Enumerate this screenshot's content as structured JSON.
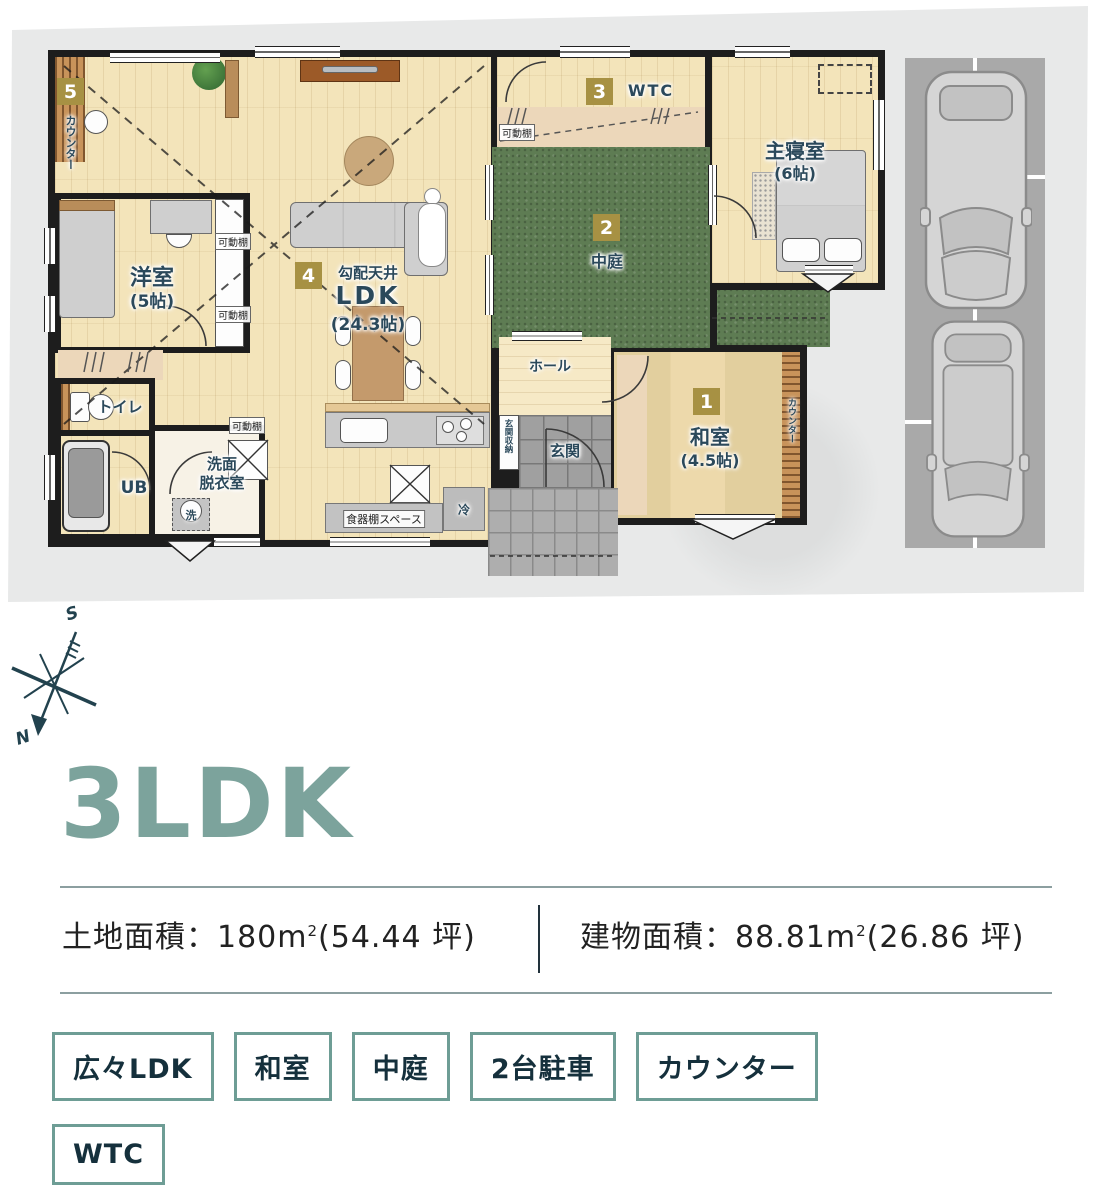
{
  "plan": {
    "badges": {
      "b1": "1",
      "b2": "2",
      "b3": "3",
      "b4": "4",
      "b5": "5"
    },
    "rooms": {
      "main_bedroom": {
        "name": "主寝室",
        "size": "(6帖)"
      },
      "western_room": {
        "name": "洋室",
        "size": "(5帖)"
      },
      "japanese_room": {
        "name": "和室",
        "size": "(4.5帖)"
      },
      "ldk": {
        "ceiling": "勾配天井",
        "name": "LDK",
        "size": "(24.3帖)"
      },
      "courtyard": {
        "name": "中庭"
      },
      "wtc": {
        "name": "WTC"
      },
      "hall": {
        "name": "ホール"
      },
      "entrance": {
        "name": "玄関"
      },
      "toilet": {
        "name": "トイレ"
      },
      "bath": {
        "name": "UB"
      },
      "washroom": {
        "line1": "洗面",
        "line2": "脱衣室"
      }
    },
    "small": {
      "movable_shelf": "可動棚",
      "entrance_storage": "玄関収納",
      "counter": "カウンター",
      "dish_shelf": "食器棚スペース",
      "fridge": "冷",
      "washer": "洗"
    },
    "compass": {
      "south": "S",
      "north": "N"
    }
  },
  "info": {
    "title": "3LDK",
    "land_label": "土地面積：",
    "land_value": "180m",
    "land_sup": "2",
    "land_tsubo": "(54.44 坪)",
    "building_label": "建物面積：",
    "building_value": "88.81m",
    "building_sup": "2",
    "building_tsubo": "(26.86 坪)"
  },
  "tags": [
    {
      "label": "広々LDK"
    },
    {
      "label": "和室"
    },
    {
      "label": "中庭"
    },
    {
      "label": "2台駐車"
    },
    {
      "label": "カウンター"
    },
    {
      "label": "WTC"
    }
  ],
  "colors": {
    "accent_teal": "#7ca39c",
    "tag_border": "#6e9d95",
    "badge_gold": "#a79143",
    "text_navy": "#15303c",
    "courtyard_green": "#5e7c53",
    "wall_black": "#1d1d1d"
  }
}
